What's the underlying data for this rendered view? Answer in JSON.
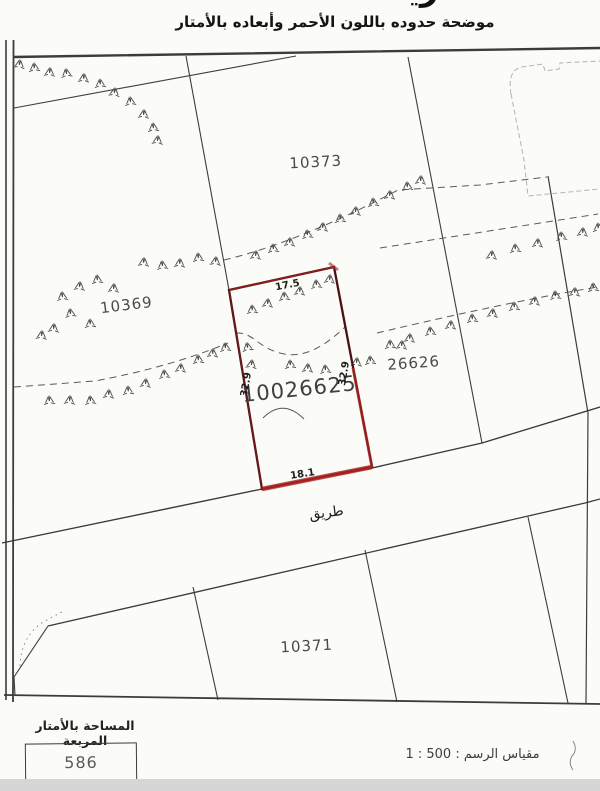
{
  "header": {
    "title_fragment": "خريطة",
    "note": "موضحة حدوده باللون الأحمر وأبعاده بالأمتار"
  },
  "map": {
    "parcel_labels": {
      "north": "10373",
      "west": "10369",
      "east": "26626",
      "south": "10371"
    },
    "plot": {
      "number": "10026625",
      "outline_color": "#8b1c1c",
      "dim_top": "17.5",
      "dim_bottom": "18.1",
      "dim_left": "32.9",
      "dim_right": "32.9"
    },
    "road_label": "طريق"
  },
  "footer": {
    "area_label": "المساحة بالأمتار المربعة",
    "area_value": "586",
    "scale_label": "مقياس الرسم : 500 : 1"
  }
}
